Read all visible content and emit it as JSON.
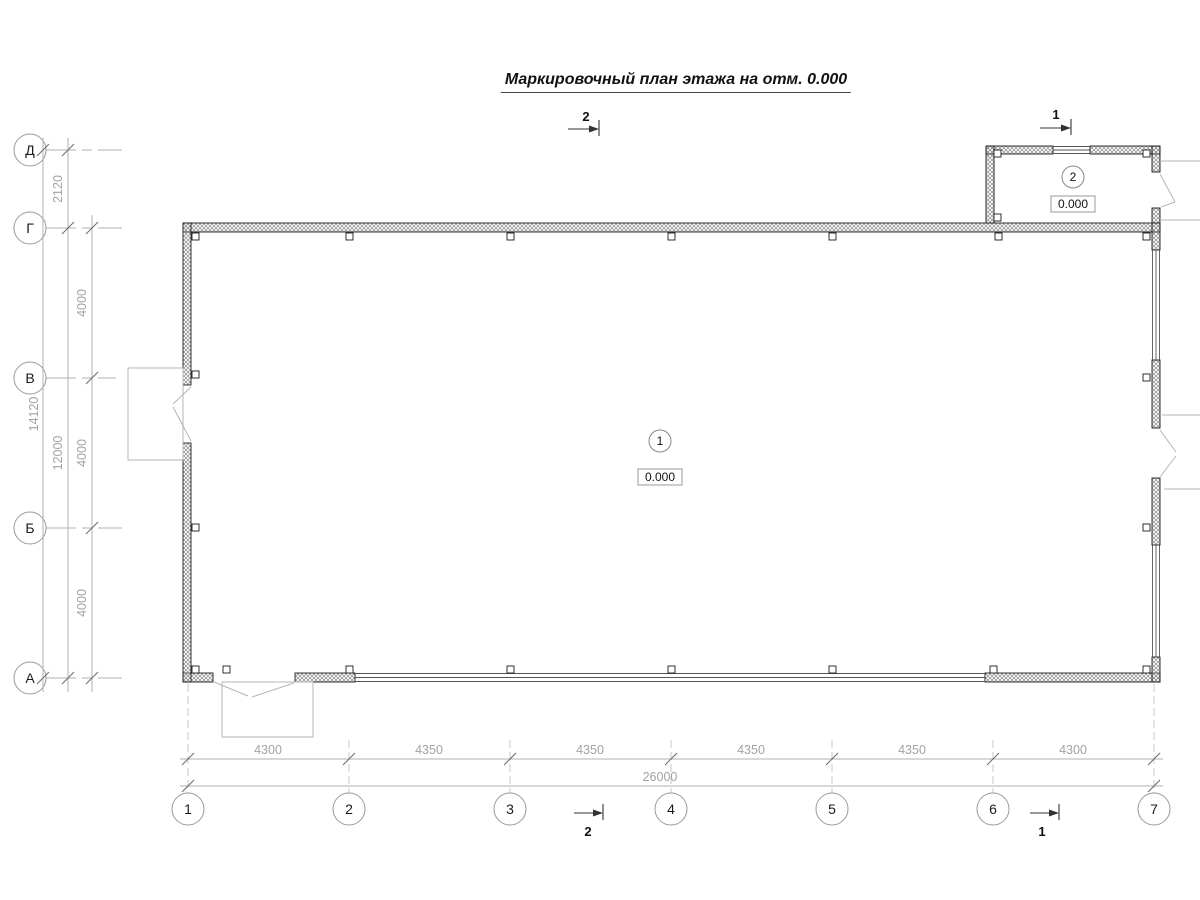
{
  "title": "Маркировочный план этажа на отм. 0.000",
  "grid": {
    "row_axes": [
      "Д",
      "Г",
      "В",
      "Б",
      "А"
    ],
    "col_axes": [
      "1",
      "2",
      "3",
      "4",
      "5",
      "6",
      "7"
    ]
  },
  "dims": {
    "vertical": {
      "segments": [
        "2120",
        "4000",
        "4000",
        "4000"
      ],
      "subtotal": "12000",
      "total": "14120"
    },
    "horizontal": {
      "segments": [
        "4300",
        "4350",
        "4350",
        "4350",
        "4350",
        "4300"
      ],
      "total": "26000"
    }
  },
  "rooms": [
    {
      "number": "1",
      "elevation": "0.000"
    },
    {
      "number": "2",
      "elevation": "0.000"
    }
  ],
  "sections": {
    "top_left": "2",
    "top_right": "1",
    "bottom_left": "2",
    "bottom_right": "1"
  },
  "colors": {
    "wall_line": "#1a1a1a",
    "hatch": "#8a8a8a",
    "thin_line": "#b0b0b0",
    "dim_text": "#a3a3a3",
    "background": "#ffffff"
  }
}
